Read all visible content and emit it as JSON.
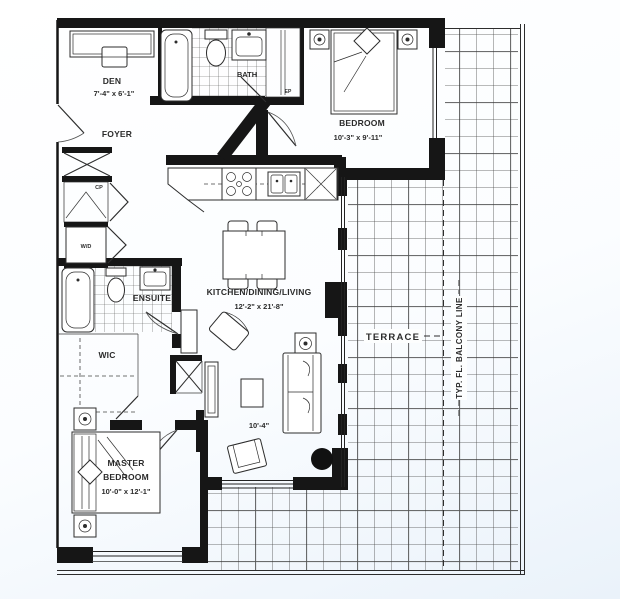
{
  "colors": {
    "wall": "#161616",
    "line": "#2d2d2d",
    "text": "#2b2b2b",
    "tile_line": "#484848",
    "background": "#ffffff",
    "page_tint": "#eaf2fa"
  },
  "rooms": {
    "den": {
      "label": "DEN",
      "dims": "7'-4\" x 6'-1\""
    },
    "foyer": {
      "label": "FOYER"
    },
    "bath": {
      "label": "BATH"
    },
    "bedroom": {
      "label": "BEDROOM",
      "dims": "10'-3\" x 9'-11\""
    },
    "kitchen": {
      "label": "KITCHEN/DINING/LIVING",
      "dims": "12'-2\" x 21'-8\"",
      "living_dim": "10'-4\""
    },
    "ensuite": {
      "label": "ENSUITE"
    },
    "wic": {
      "label": "WIC"
    },
    "master": {
      "label_line1": "MASTER",
      "label_line2": "BEDROOM",
      "dims": "10'-0\" x 12'-1\""
    },
    "terrace": {
      "label": "TERRACE"
    }
  },
  "closets": {
    "cp": "CP",
    "wd": "W/D",
    "ep": "EP"
  },
  "annotations": {
    "balcony_line": "TYP. FL. BALCONY LINE"
  }
}
